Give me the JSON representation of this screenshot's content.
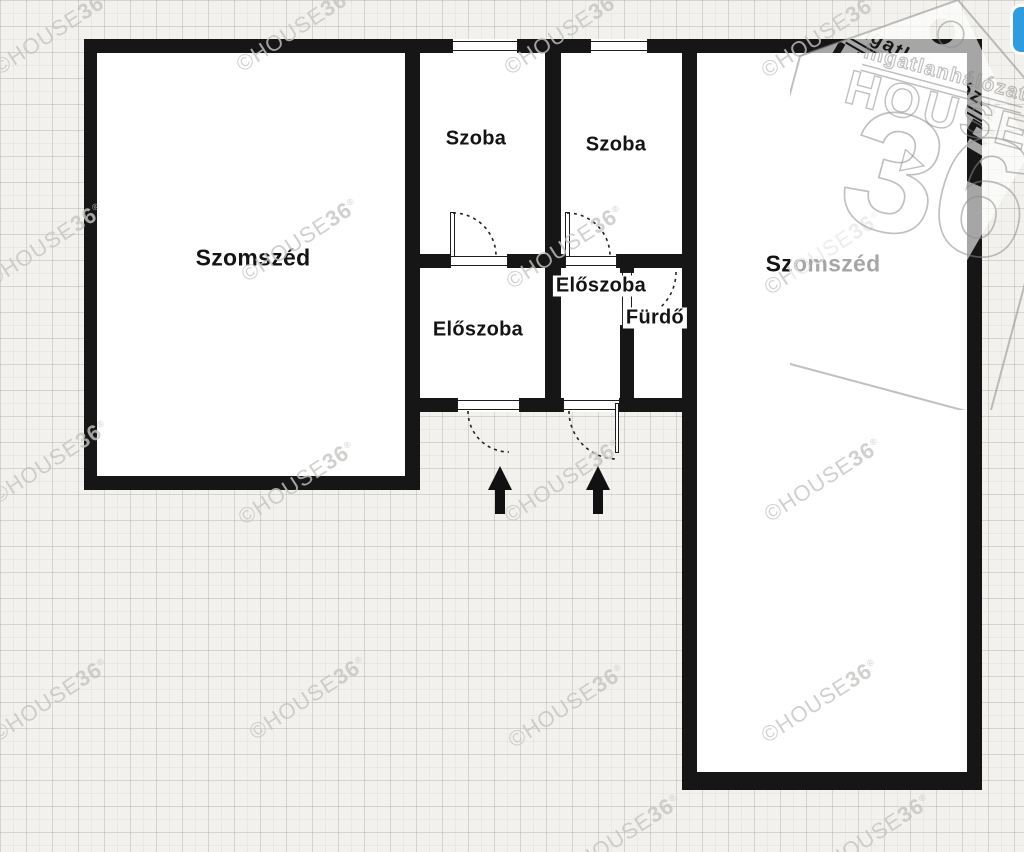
{
  "rooms": {
    "neighbor_left": {
      "label": "Szomszéd"
    },
    "neighbor_right": {
      "label": "Szomszéd"
    },
    "room_left": {
      "label": "Szoba"
    },
    "room_right": {
      "label": "Szoba"
    },
    "hall_left": {
      "label": "Előszoba"
    },
    "hall_right": {
      "label": "Előszoba"
    },
    "bath": {
      "label": "Fürdő"
    }
  },
  "watermark": {
    "prefix": "©HOUSE",
    "suffix": "36",
    "reg": "®"
  },
  "logo": {
    "network": "ingatlanhálózat",
    "brand": "HOUSE",
    "number": "36"
  },
  "colors": {
    "wall": "#161616",
    "background": "#f2f1ed",
    "grid_line": "#dcdbd4",
    "room_fill": "#ffffff",
    "watermark": "#c6c5c2",
    "accent_blue": "#2e9ce1"
  }
}
